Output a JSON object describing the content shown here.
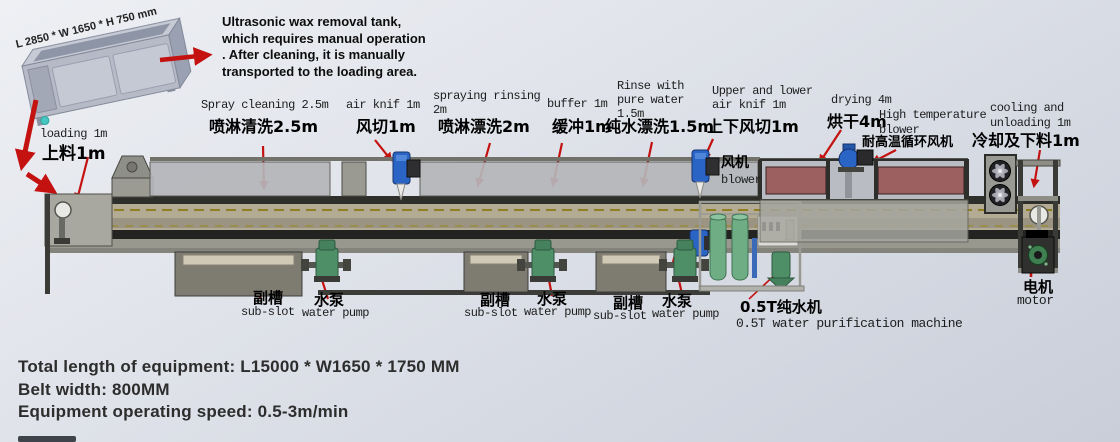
{
  "tank": {
    "dimension_label": "L 2850 * W 1650 * H 750 mm",
    "note": "Ultrasonic wax removal tank,\nwhich requires manual operation\n. After cleaning, it is manually\ntransported to the loading area."
  },
  "stations": {
    "loading": {
      "en": "loading 1m",
      "zh": "上料1m"
    },
    "spray_cleaning": {
      "en": "Spray cleaning 2.5m",
      "zh": "喷淋清洗2.5m"
    },
    "air_knife": {
      "en": "air knif 1m",
      "zh": "风切1m"
    },
    "spraying_rinsing": {
      "en": "spraying rinsing\n2m",
      "zh": "喷淋漂洗2m"
    },
    "buffer": {
      "en": "buffer 1m",
      "zh": "缓冲1m"
    },
    "pure_water_rinse": {
      "en": "Rinse with\npure water\n1.5m",
      "zh": "纯水漂洗1.5m"
    },
    "upper_lower_air_knife": {
      "en": "Upper and lower\nair knif 1m",
      "zh": "上下风切1m"
    },
    "blower": {
      "zh": "风机",
      "en": "blower"
    },
    "drying": {
      "en": "drying 4m",
      "zh": "烘干4m"
    },
    "high_temperature_blower": {
      "en": "High temperature\nblower",
      "zh": "耐高温循环风机"
    },
    "cooling_unloading": {
      "en": "cooling and\nunloading 1m",
      "zh": "冷却及下料1m"
    }
  },
  "components": {
    "sub_slot": {
      "zh": "副槽",
      "en": "sub-slot"
    },
    "water_pump": {
      "zh": "水泵",
      "en": "water pump"
    },
    "purifier": {
      "zh": "0.5T纯水机",
      "en": "0.5T water purification machine"
    },
    "motor": {
      "zh": "电机",
      "en": "motor"
    }
  },
  "specs": {
    "total_length": "Total length of equipment: L15000 * W1650 * 1750 MM",
    "belt_width": "Belt width: 800MM",
    "speed": "Equipment operating speed: 0.5-3m/min"
  },
  "colors": {
    "arrow_red": "#c41210",
    "machine_gray": "#9a9a93",
    "belt_beige": "#b3ab93",
    "pump_green": "#4f8f68",
    "blower_blue": "#2a64c4",
    "heater_red": "#9c6060",
    "transducer_teal": "#45c6c0"
  }
}
